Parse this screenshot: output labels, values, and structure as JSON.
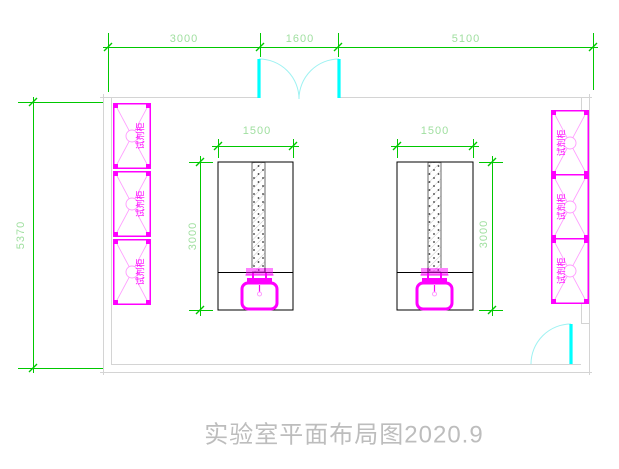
{
  "title": "实验室平面布局图2020.9",
  "dimensions": {
    "top_left": "3000",
    "top_middle": "1600",
    "top_right": "5100",
    "wall_height": "5370",
    "bench_width": "1500",
    "bench_length": "3000"
  },
  "labels": {
    "reagent_cabinet": "试剂柜"
  },
  "counts": {
    "left_wall_cabinets": 3,
    "right_wall_cabinets": 3,
    "center_benches": 2,
    "sinks": 2,
    "doors": 2
  },
  "colors": {
    "dimension_line": "#00c800",
    "dimension_text": "#9fdf9f",
    "furniture_magenta": "#ff00ff",
    "door_cyan": "#00ffff",
    "wall_gray": "#d4d4d4",
    "bench_outline": "#000000",
    "title_text": "#bdbdbd"
  }
}
